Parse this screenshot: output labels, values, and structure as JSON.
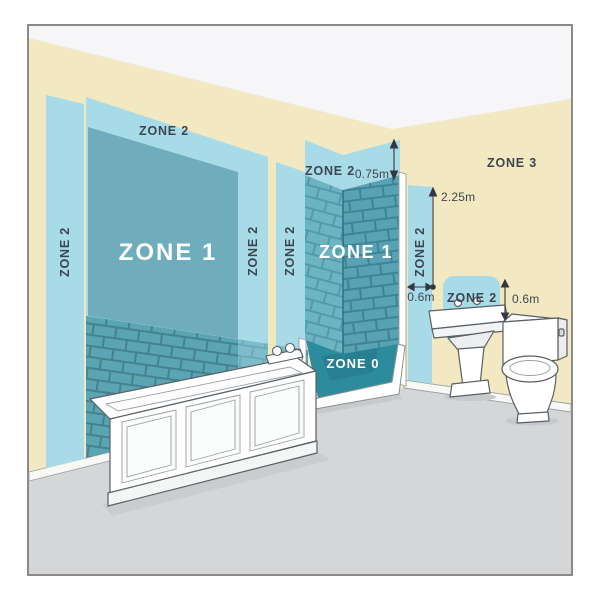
{
  "diagram": {
    "subject": "bathroom-electrical-zones",
    "zones": {
      "bath": {
        "zone2_top": "ZONE 2",
        "zone2_left": "ZONE 2",
        "zone2_inner": "ZONE 2",
        "zone2_outer": "ZONE 2",
        "zone1": "ZONE 1"
      },
      "shower": {
        "zone2_top": "ZONE 2",
        "zone1": "ZONE 1",
        "zone0": "ZONE 0",
        "zone2_side": "ZONE 2"
      },
      "basin": {
        "zone2": "ZONE 2"
      },
      "wall": {
        "zone3": "ZONE 3"
      }
    },
    "measurements": {
      "shower_band_height": "0.75m",
      "zone_total_height": "2.25m",
      "shower_side_width": "0.6m",
      "basin_zone_height": "0.6m"
    },
    "colors": {
      "wall": "#f2e8c1",
      "ceiling": "#f6f6f8",
      "floor": "#d5d6d8",
      "zone2": "#a7dbe8",
      "zone1": "#6fadbc",
      "zone0_tray": "#2d8b9e",
      "tile": "#5aa4b3",
      "tile_grout": "#45828f",
      "text_dark": "#3f4550",
      "text_light": "#ffffff",
      "line": "#33383f"
    }
  }
}
